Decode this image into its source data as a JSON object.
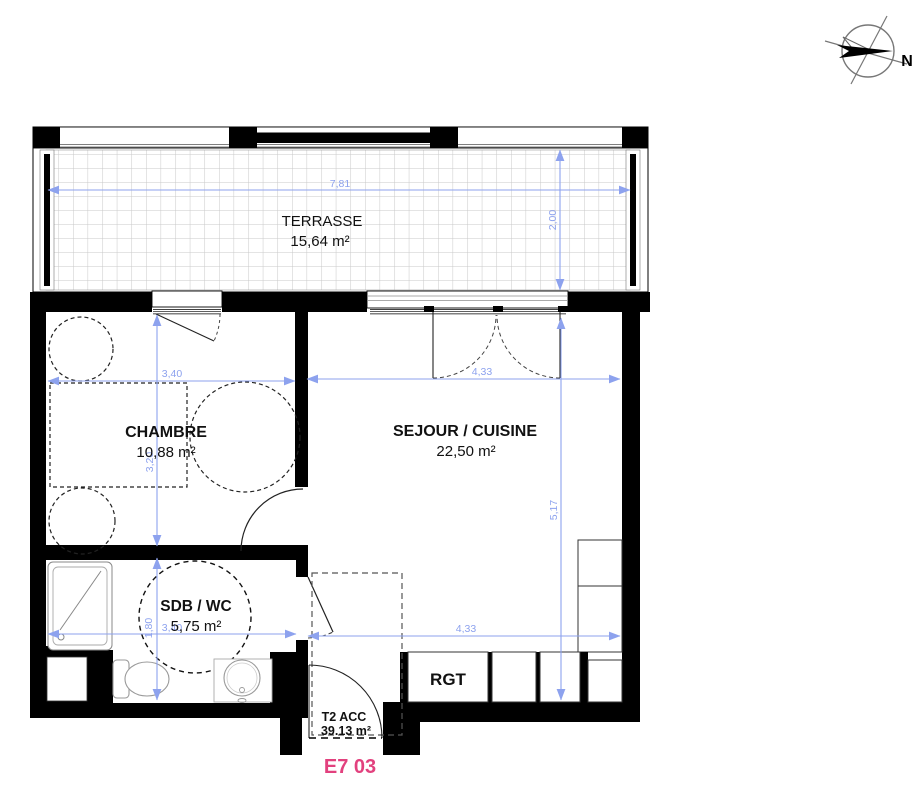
{
  "compass": {
    "north": "N"
  },
  "rooms": {
    "terrasse": {
      "name": "TERRASSE",
      "area": "15,64 m²"
    },
    "chambre": {
      "name": "CHAMBRE",
      "area": "10,88 m²"
    },
    "sejour": {
      "name": "SEJOUR / CUISINE",
      "area": "22,50 m²"
    },
    "sdb": {
      "name": "SDB / WC",
      "area": "5,75 m²"
    },
    "rgt": {
      "name": "RGT"
    }
  },
  "dimensions": {
    "terrace_width": "7,81",
    "terrace_depth": "2,00",
    "chambre_width": "3,40",
    "sejour_width": "4,33",
    "chambre_depth": "3,20",
    "sejour_depth": "5,17",
    "sdb_width": "3,40",
    "entry_width": "4,33",
    "sdb_depth": "1,80"
  },
  "unit": {
    "type": "T2 ACC",
    "area": "39.13 m²",
    "lot": "E7 03"
  },
  "colors": {
    "dimension": "#8da2ee",
    "wall": "#000000",
    "lot_label": "#e2417e"
  }
}
